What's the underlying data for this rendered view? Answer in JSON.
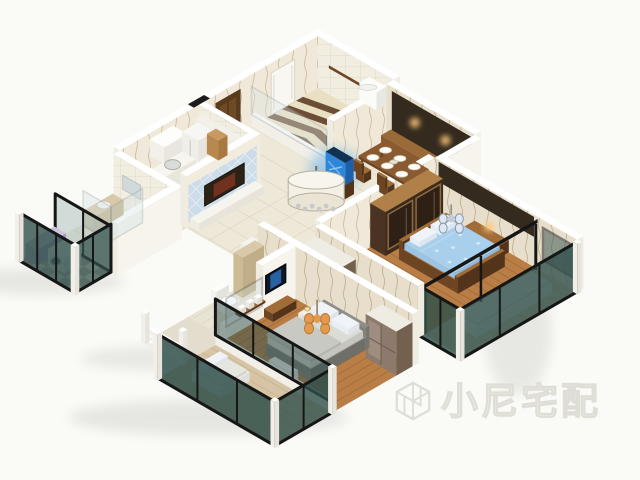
{
  "image": {
    "width": 640,
    "height": 480,
    "kind": "3d-isometric-apartment-floor-plan-render"
  },
  "watermark": {
    "text": "小尼宅配",
    "logo": "cube-outline-icon",
    "color": "#e9e9e2"
  },
  "rooms": [
    "entry-hall",
    "kitchen",
    "bathroom-top",
    "bathroom-left",
    "laundry-balcony",
    "living-room",
    "dining-area",
    "bedroom-right",
    "glazed-balcony-right",
    "master-bedroom",
    "ensuite-bathroom",
    "terrace",
    "master-balcony"
  ],
  "palette": {
    "bg": "#fafaf6",
    "wallTop": "#ffffff",
    "white": "#fdfdfb",
    "wallEnd": "#efece2",
    "wallFlat": "#f4f1e8",
    "marble": "#eee8d9",
    "marbleLine": "#ddd5c2",
    "kitchenFloor": "#efebdf",
    "gridLine": "#d9d4c6",
    "zigBrown": "#5f4129",
    "zigCream": "#e9dfc2",
    "checkerA": "#e8e4da",
    "checkerB": "#bab3a4",
    "woodFloor": "#b97e46",
    "woodLine": "#97622f",
    "corridorWood": "#b27741",
    "balconyWood": "#d6c4a4",
    "balconyWoodLine": "#c0ab85",
    "wood": "#8a5a30",
    "woodMid": "#a06c38",
    "woodDark": "#6e4522",
    "woodDeep": "#53341a",
    "panelDark": "#342a1e",
    "doorBrown": "#5a3a1c",
    "doorBrownLight": "#6f4a26",
    "doorWhite": "#f8f7f2",
    "glassTeal": "#31504b",
    "glassLight": "#cfe0e2",
    "frameBlack": "#161616",
    "silver": "#8fa09e",
    "tvBlue": "#ccdce9",
    "painting": "#2c2216",
    "paintingRed": "#7c3420",
    "aquaTop": "#123254",
    "aquaFront": "#2e86d8",
    "aquaSide": "#1d5fa8",
    "aquaGlow": "#4aa0e8",
    "aquaStreak": "#9ed2f4",
    "bedBlueTop": "#a8cfec",
    "bedBlueX": "#8fb8dc",
    "bedBlueY": "#9cc4e4",
    "dotBlue": "#d6ebf8",
    "pillow": "#f0f4f8",
    "mattress": "#dcdcd6",
    "bedGray": "#9a9a94",
    "blanket": "#c9c9c3",
    "purple": "#b3a8cc",
    "purpleTop": "#cbc3dd",
    "purpleSide": "#a195c0",
    "taupe": "#8d7a6c",
    "taupeLight": "#a29082",
    "taupeSide": "#73604f",
    "warm": "#ffc87a",
    "orange": "#e39a4e",
    "chandBlue": "#dfe8f2",
    "mirror": "#cfd8da",
    "rug": "#43453f",
    "washer": "#e8ebec",
    "washerSide": "#d6dadb",
    "washerDark": "#4a5558",
    "beige": "#d9c9a8",
    "shadow": "#000000"
  }
}
